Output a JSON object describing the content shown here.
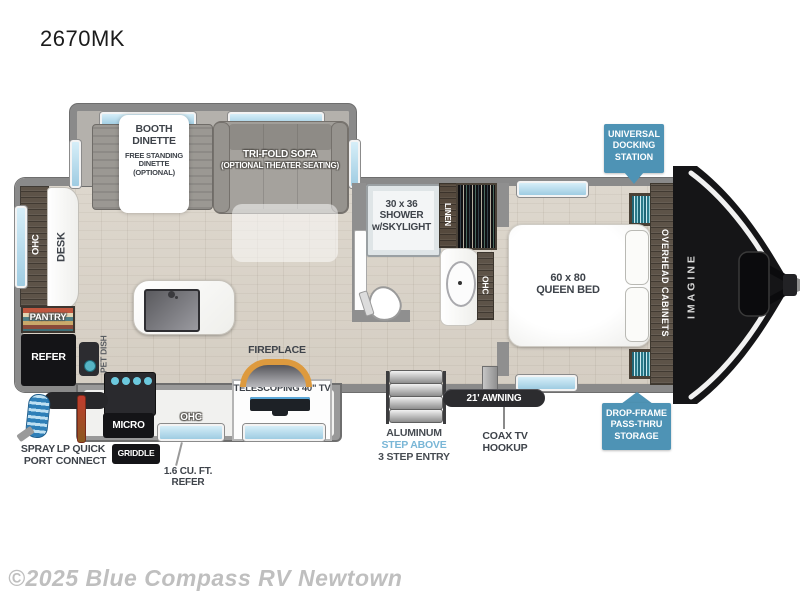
{
  "title": "2670MK",
  "watermark": "©2025 Blue Compass RV Newtown",
  "colors": {
    "badge_blue": "#4e93b5",
    "wall_gray": "#8f8f8f",
    "floor_wood": "#d9d3c9",
    "window_blue": "#aed4e8",
    "fireplace_orange": "#dd9a3e",
    "step_above_blue": "#79b6d6",
    "label_dark": "#3e434a",
    "front_cap_black": "#151517"
  },
  "badges": {
    "docking": "UNIVERSAL\nDOCKING\nSTATION",
    "storage": "DROP-FRAME\nPASS-THRU\nSTORAGE"
  },
  "slideout": {
    "dinette_title": "BOOTH\nDINETTE",
    "dinette_sub": "FREE STANDING\nDINETTE\n(OPTIONAL)",
    "sofa_title": "TRI-FOLD SOFA",
    "sofa_sub": "(OPTIONAL THEATER SEATING)"
  },
  "rear": {
    "ohc": "OHC",
    "desk": "DESK",
    "pantry": "PANTRY",
    "refer": "REFER",
    "pet_dish": "PET DISH",
    "spray_port": "SPRAY\nPORT",
    "lp_quick": "LP QUICK\nCONNECT"
  },
  "kitchen": {
    "micro": "MICRO",
    "griddle": "GRIDDLE",
    "ohc": "OHC",
    "mini_refer": "1.6 CU. FT.\nREFER",
    "fireplace": "FIREPLACE",
    "tv": "TELESCOPING 40\" TV"
  },
  "bath": {
    "shower": "30 x 36\nSHOWER\nw/SKYLIGHT",
    "linen": "LINEN",
    "ohc": "OHC"
  },
  "bedroom": {
    "bed": "60 x 80\nQUEEN BED",
    "overhead": "OVERHEAD CABINETS",
    "brand": "IMAGINE"
  },
  "entry": {
    "awning": "21' AWNING",
    "coax": "COAX TV\nHOOKUP",
    "step_l1": "ALUMINUM",
    "step_l2": "STEP ABOVE",
    "step_l3": "3 STEP ENTRY"
  }
}
